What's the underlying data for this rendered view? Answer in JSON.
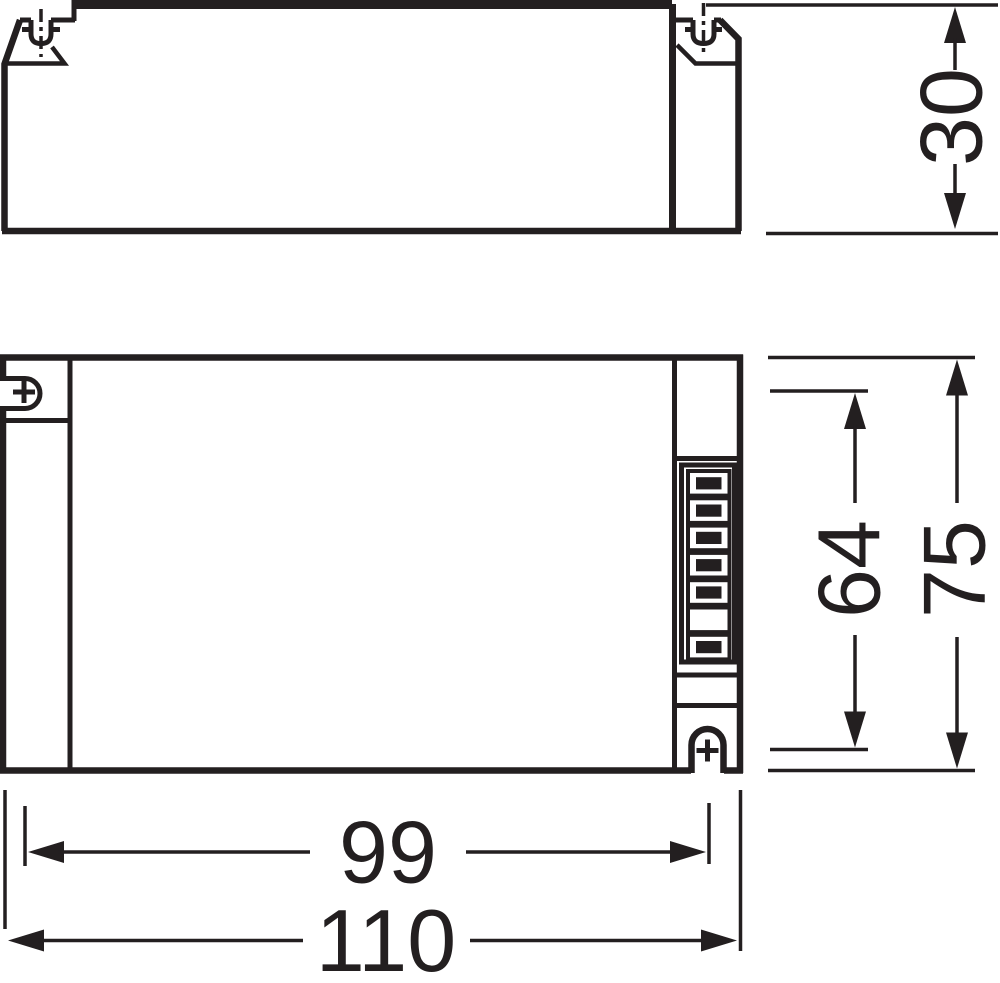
{
  "palette": {
    "ink": "#231f20",
    "paper": "#ffffff"
  },
  "dimensions": {
    "height": "30",
    "slot_spacing_vertical": "64",
    "width": "75",
    "slot_spacing_horizontal": "99",
    "length": "110"
  },
  "terminal_block": {
    "cell_count": 7,
    "filled_cells": [
      1,
      2,
      3,
      4,
      5,
      7
    ]
  }
}
